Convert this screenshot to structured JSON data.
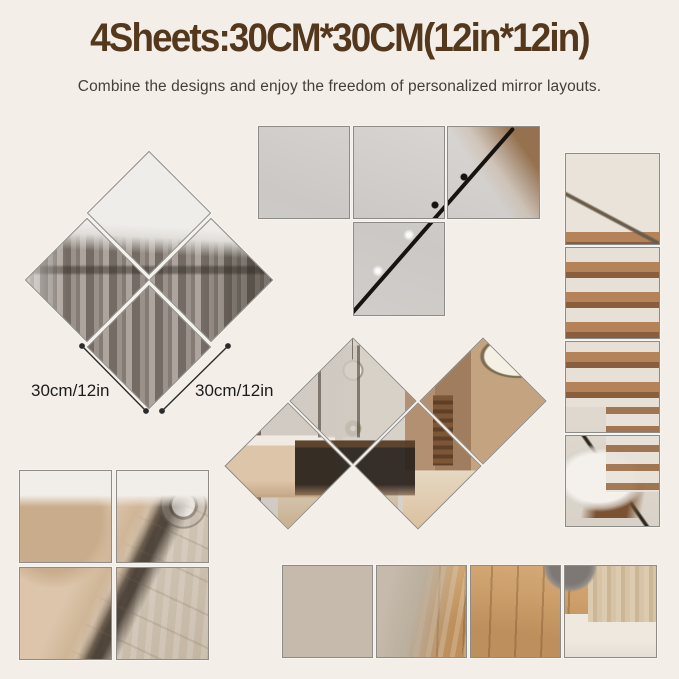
{
  "header": {
    "title": "4Sheets:30CM*30CM(12in*12in)",
    "subtitle": "Combine the designs and enjoy the freedom of personalized mirror layouts."
  },
  "dimensions": {
    "left_label": "30cm/12in",
    "right_label": "30cm/12in"
  },
  "arrangements": [
    {
      "name": "rotated-2x2-diamond-grid",
      "tiles": 4,
      "scene": "gray curtains and white ceiling"
    },
    {
      "name": "t-shape-grid",
      "tiles": 4,
      "scene": "gray ceiling with black track lighting"
    },
    {
      "name": "diamond-zigzag-strip",
      "tiles": 4,
      "scene": "living and dining room panorama"
    },
    {
      "name": "vertical-1x4-column",
      "tiles": 4,
      "scene": "wooden staircase and side table"
    },
    {
      "name": "square-2x2-grid",
      "tiles": 4,
      "scene": "beige sofa and carpet"
    },
    {
      "name": "horizontal-4x1-row",
      "tiles": 4,
      "scene": "carpet transitioning to wood floor"
    }
  ],
  "colors": {
    "background": "#f3efe8",
    "title_text": "#54381d",
    "subtitle_text": "#44403a",
    "label_text": "#1c1c1c",
    "mirror_border": "#8e8c89"
  }
}
